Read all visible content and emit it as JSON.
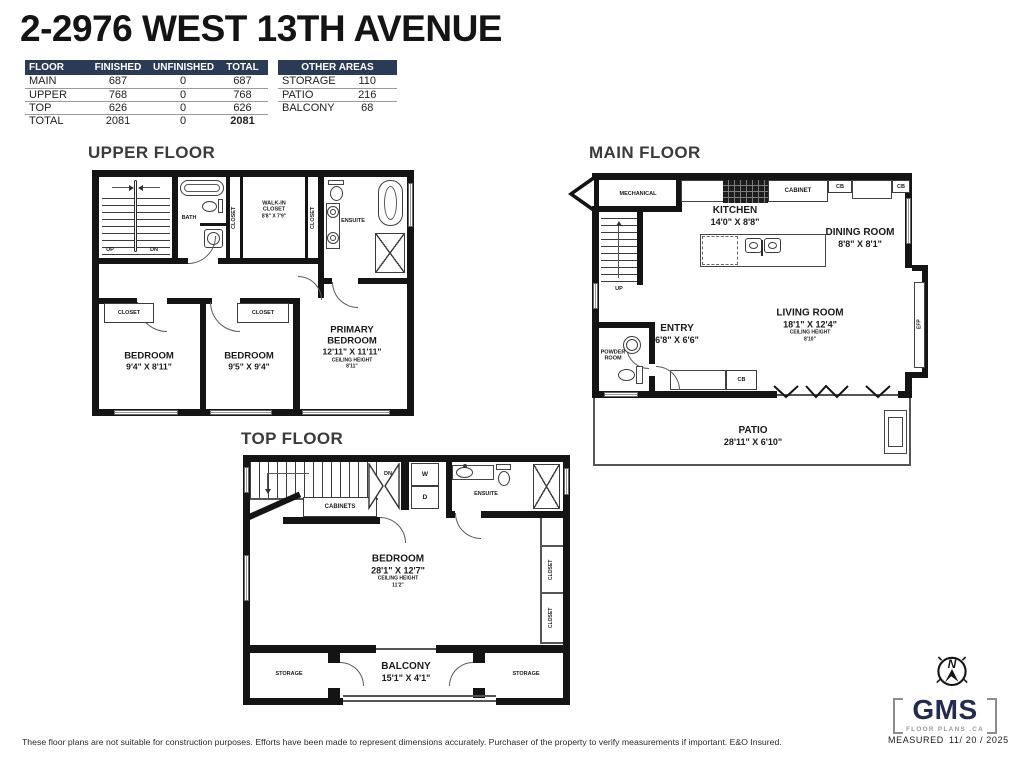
{
  "title": "2-2976 WEST 13TH AVENUE",
  "tables": {
    "area": {
      "headers": [
        "FLOOR",
        "FINISHED",
        "UNFINISHED",
        "TOTAL"
      ],
      "rows": [
        [
          "MAIN",
          "687",
          "0",
          "687"
        ],
        [
          "UPPER",
          "768",
          "0",
          "768"
        ],
        [
          "TOP",
          "626",
          "0",
          "626"
        ],
        [
          "TOTAL",
          "2081",
          "0",
          "2081"
        ]
      ]
    },
    "other": {
      "header": "OTHER AREAS",
      "rows": [
        [
          "STORAGE",
          "110"
        ],
        [
          "PATIO",
          "216"
        ],
        [
          "BALCONY",
          "68"
        ]
      ]
    }
  },
  "floors": {
    "upper": {
      "title": "UPPER FLOOR",
      "labels": {
        "up": "UP",
        "dn": "DN",
        "bath": "BATH",
        "closet_left": "CLOSET",
        "closet_right": "CLOSET",
        "walkin_name": "WALK-IN CLOSET",
        "walkin_dim": "8'8\" X 7'9\"",
        "ensuite": "ENSUITE",
        "closet_b1": "CLOSET",
        "closet_b2": "CLOSET",
        "bedroom1_name": "BEDROOM",
        "bedroom1_dim": "9'4\" X 8'11\"",
        "bedroom2_name": "BEDROOM",
        "bedroom2_dim": "9'5\" X 9'4\"",
        "primary_name": "PRIMARY BEDROOM",
        "primary_dim": "12'11\" X 11'11\"",
        "primary_ch": "CEILING HEIGHT",
        "primary_chv": "8'11\""
      }
    },
    "main": {
      "title": "MAIN FLOOR",
      "labels": {
        "mechanical": "MECHANICAL",
        "up": "UP",
        "kitchen_name": "KITCHEN",
        "kitchen_dim": "14'0\" X 8'8\"",
        "cabinet": "CABINET",
        "cb1": "CB",
        "cb2": "CB",
        "cb3": "CB",
        "dining_name": "DINING ROOM",
        "dining_dim": "8'8\" X 8'1\"",
        "living_name": "LIVING ROOM",
        "living_dim": "18'1\" X 12'4\"",
        "living_ch": "CEILING HEIGHT",
        "living_chv": "8'10\"",
        "entry_name": "ENTRY",
        "entry_dim": "6'8\" X 6'6\"",
        "powder": "POWDER ROOM",
        "efp": "EFP",
        "patio_name": "PATIO",
        "patio_dim": "28'11\" X 6'10\""
      }
    },
    "top": {
      "title": "TOP FLOOR",
      "labels": {
        "dn": "DN",
        "cabinets": "CABINETS",
        "washer": "W",
        "dryer": "D",
        "ensuite": "ENSUITE",
        "closet1": "CLOSET",
        "closet2": "CLOSET",
        "bedroom_name": "BEDROOM",
        "bedroom_dim": "28'1\" X 12'7\"",
        "bedroom_ch": "CEILING HEIGHT",
        "bedroom_chv": "11'2\"",
        "balcony_name": "BALCONY",
        "balcony_dim": "15'1\" X 4'1\"",
        "storage1": "STORAGE",
        "storage2": "STORAGE"
      }
    }
  },
  "footer": {
    "disclaimer": "These floor plans are not suitable for construction purposes. Efforts have been made to represent dimensions accurately.  Purchaser of the property to verify measurements if important.  E&O Insured.",
    "logo_brand": "GMS",
    "logo_sub": "FLOOR PLANS .CA",
    "measured_label": "MEASURED",
    "measured_date": "11/ 20 / 2025",
    "compass_letter": "N"
  },
  "colors": {
    "table_header_bg": "#2b3a55",
    "wall": "#141414",
    "logo_navy": "#232c4e"
  }
}
